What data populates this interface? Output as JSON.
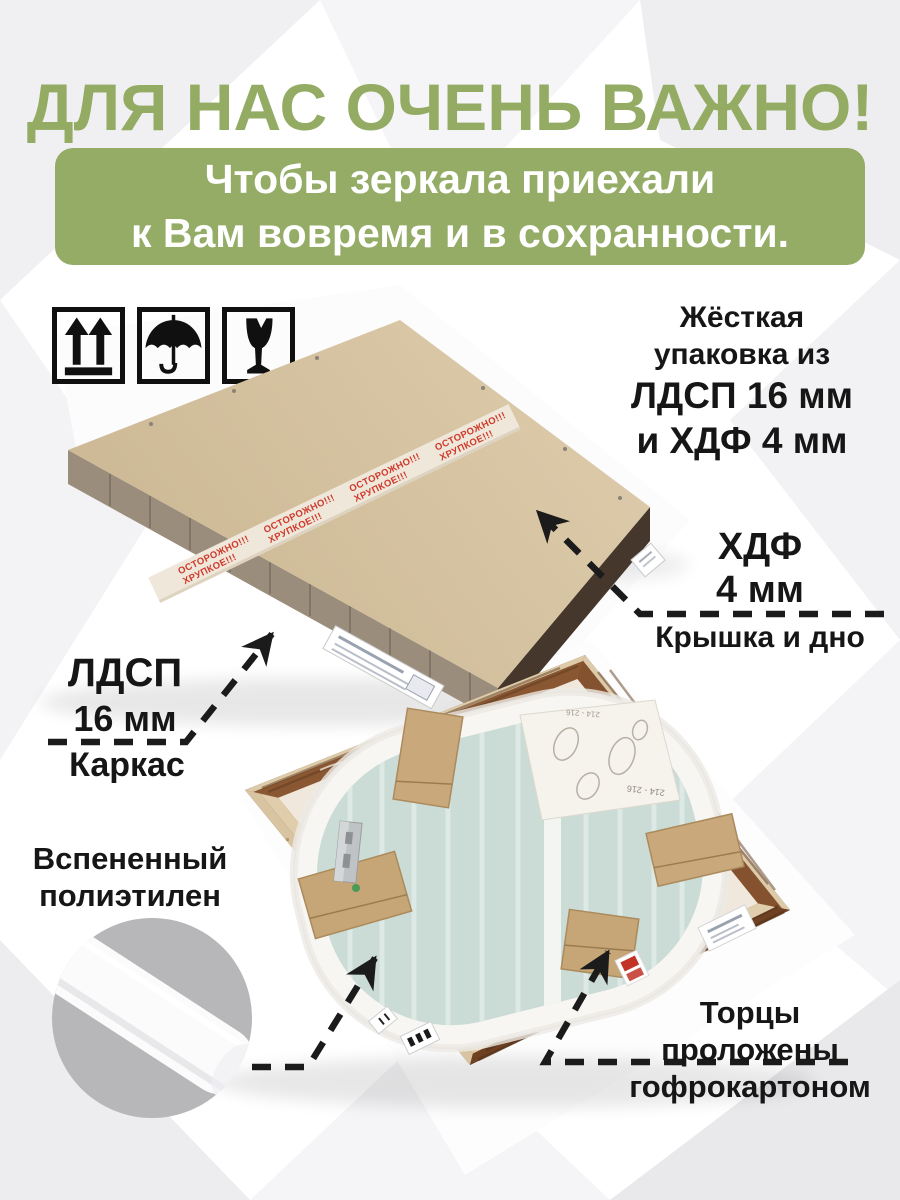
{
  "page": {
    "title": "ДЛЯ НАС ОЧЕНЬ ВАЖНО!",
    "banner": {
      "line1": "Чтобы зеркала приехали",
      "line2": "к Вам вовремя и в сохранности."
    }
  },
  "handling_icons": [
    {
      "name": "this-way-up"
    },
    {
      "name": "keep-dry-umbrella"
    },
    {
      "name": "fragile-broken-glass"
    }
  ],
  "annotations": {
    "rigid": {
      "line1": "Жёсткая",
      "line2": "упаковка из",
      "line3": "ЛДСП 16 мм",
      "line4": "и ХДФ 4 мм"
    },
    "hdf": {
      "material": "ХДФ",
      "thickness": "4 мм",
      "caption": "Крышка и дно"
    },
    "ldsp": {
      "material": "ЛДСП",
      "thickness": "16 мм",
      "caption": "Каркас"
    },
    "foam": {
      "line1": "Вспененный",
      "line2": "полиэтилен"
    },
    "edges": {
      "line1": "Торцы",
      "line2": "проложены",
      "line3": "гофрокартоном"
    }
  },
  "top_photo": {
    "tape_line1": "ОСТОРОЖНО!!!",
    "tape_line2": "ХРУПКОЕ!!!"
  },
  "bottom_photo": {
    "sheet_text": "214 - 216"
  },
  "colors": {
    "accent_green": "#94ac66",
    "ink": "#161616",
    "kraft": "#d6c3a1",
    "tape_red": "#cf3a2c",
    "mirror_glass": "#ccdcd8",
    "wood": "#7c4e2b",
    "foam_circle_gray": "#b7b7b9"
  }
}
